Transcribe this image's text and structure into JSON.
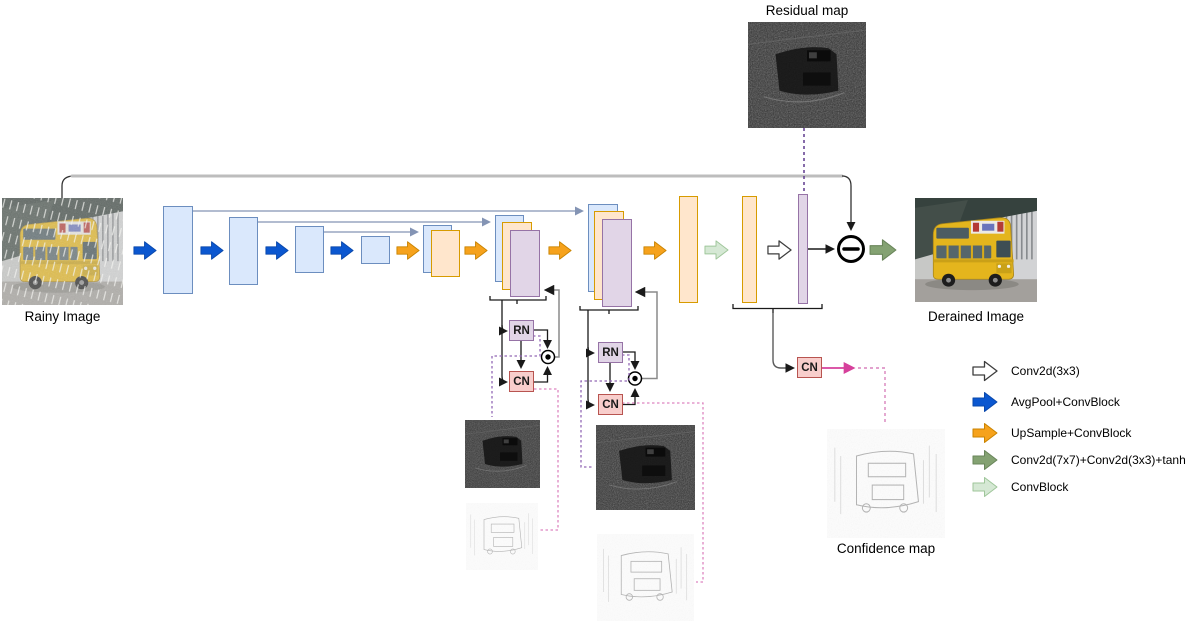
{
  "labels": {
    "rainy_image": "Rainy Image",
    "derained_image": "Derained Image",
    "residual_map": "Residual map",
    "confidence_map": "Confidence map"
  },
  "blocks": {
    "rn": "RN",
    "cn": "CN"
  },
  "operators": {
    "subtract": "−",
    "elementwise_product": "⊙"
  },
  "legend": {
    "items": [
      {
        "name": "conv2d-3x3",
        "label": "Conv2d(3x3)",
        "fill": "#ffffff",
        "stroke": "#3d3d3d"
      },
      {
        "name": "avgpool-convblock",
        "label": "AvgPool+ConvBlock",
        "fill": "#0b57d0",
        "stroke": "#0a48ab"
      },
      {
        "name": "upsample-convblock",
        "label": "UpSample+ConvBlock",
        "fill": "#f6a21c",
        "stroke": "#c98300"
      },
      {
        "name": "conv7x7-conv3x3-tanh",
        "label": "Conv2d(7x7)+Conv2d(3x3)+tanh()",
        "fill": "#84a272",
        "stroke": "#69855a"
      },
      {
        "name": "convblock",
        "label": "ConvBlock",
        "fill": "#d5e8d4",
        "stroke": "#9fc69a"
      }
    ]
  },
  "colors": {
    "encoder_block_fill": "#dae8fc",
    "encoder_block_stroke": "#6c8ebf",
    "decoder_block_fill": "#ffe6cc",
    "decoder_block_stroke": "#d79b00",
    "refinement_block_fill": "#e1d5e7",
    "refinement_block_stroke": "#9673a6",
    "cn_block_fill": "#f8cecc",
    "cn_block_stroke": "#b85450",
    "skip_connection": "#8494b4",
    "confidence_link_pink": "#d6409b",
    "residual_link_purple": "#5e3a8e"
  }
}
